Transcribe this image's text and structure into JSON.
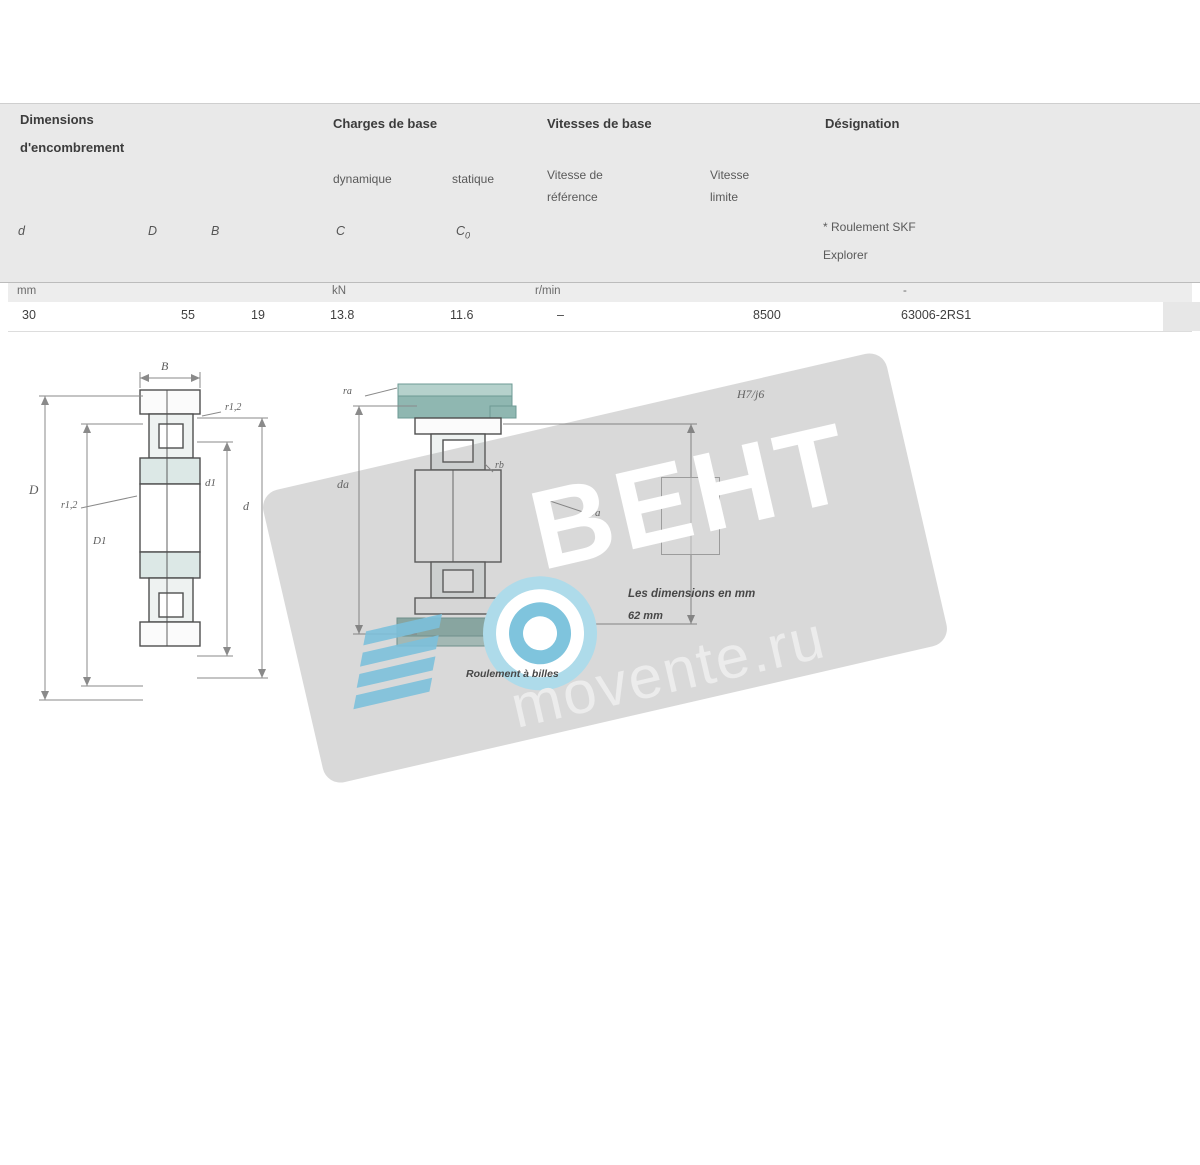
{
  "table": {
    "headers": {
      "dim_line1": "Dimensions",
      "dim_line2": "d'encombrement",
      "charges": "Charges de base",
      "vitesses": "Vitesses de base",
      "designation": "Désignation"
    },
    "subheaders": {
      "dynamique": "dynamique",
      "statique": "statique",
      "vref_line1": "Vitesse de",
      "vref_line2": "référence",
      "vlim_line1": "Vitesse",
      "vlim_line2": "limite",
      "explorer_line1": "* Roulement SKF",
      "explorer_line2": "Explorer"
    },
    "columns": {
      "d": "d",
      "D": "D",
      "B": "B",
      "C": "C",
      "C0_base": "C",
      "C0_sub": "0"
    },
    "units": {
      "mm": "mm",
      "kn": "kN",
      "rmin": "r/min",
      "dash": "-"
    },
    "row": {
      "d": "30",
      "D": "55",
      "B": "19",
      "C": "13.8",
      "C0": "11.6",
      "vref": "–",
      "vlim": "8500",
      "designation": "63006-2RS1"
    }
  },
  "figures": {
    "fig1": {
      "B": "B",
      "r12_top": "r1,2",
      "D": "D",
      "r12_mid": "r1,2",
      "D1": "D1",
      "d1": "d1",
      "d": "d",
      "caption": "Roulement à billes"
    },
    "fig2": {
      "ra": "ra",
      "da": "da",
      "rb": "rb",
      "Da": "Da",
      "fit": "H7/j6"
    },
    "fig3": {
      "caption_line1": "Les dimensions en mm",
      "caption_line2": "62 mm"
    }
  },
  "watermark": {
    "brand": "ВЕНТ",
    "site": "movente.ru"
  },
  "colors": {
    "header_band": "#e9e9e9",
    "units_band": "#ededed",
    "teal": "#8fb7b1",
    "teal_light": "#b5d1cc",
    "teal_dark": "#6d9a94",
    "wm_blue": "#7fc4dd",
    "wm_band": "#d1d1d1"
  }
}
